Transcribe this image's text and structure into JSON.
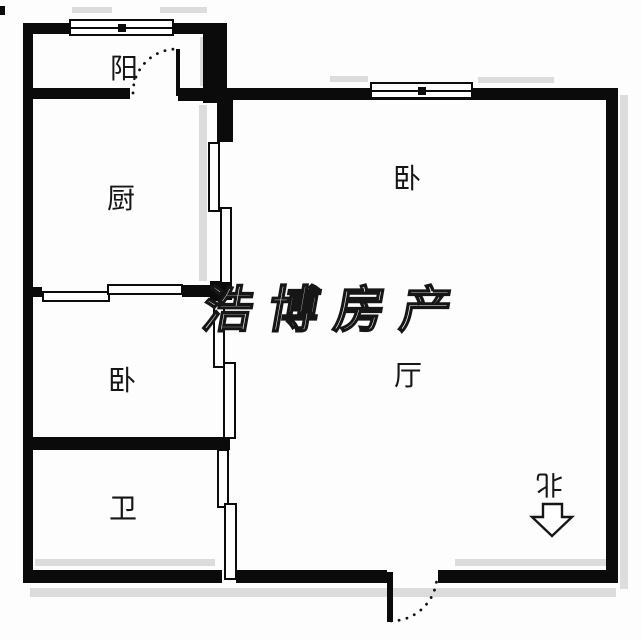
{
  "floorplan": {
    "title": "apartment-floor-plan",
    "watermark_text": "浩博房产",
    "rooms": [
      {
        "id": "balcony",
        "label": "阳"
      },
      {
        "id": "kitchen",
        "label": "厨"
      },
      {
        "id": "bedroom-north",
        "label": "卧"
      },
      {
        "id": "living-room",
        "label": "厅"
      },
      {
        "id": "bedroom-west",
        "label": "卧"
      },
      {
        "id": "bathroom",
        "label": "卫"
      }
    ],
    "compass": {
      "label": "北",
      "direction": "down"
    },
    "doors": [
      {
        "id": "balcony-door",
        "type": "swing"
      },
      {
        "id": "entry-door",
        "type": "swing"
      }
    ],
    "windows": [
      {
        "id": "balcony-window"
      },
      {
        "id": "bedroom-north-window"
      }
    ],
    "colors": {
      "wall": "#0b0b0b",
      "background": "#fdfdfd",
      "shadow": "#dcdcdc",
      "watermark_outline": "#161616",
      "watermark_fill": "#ffffff"
    }
  }
}
